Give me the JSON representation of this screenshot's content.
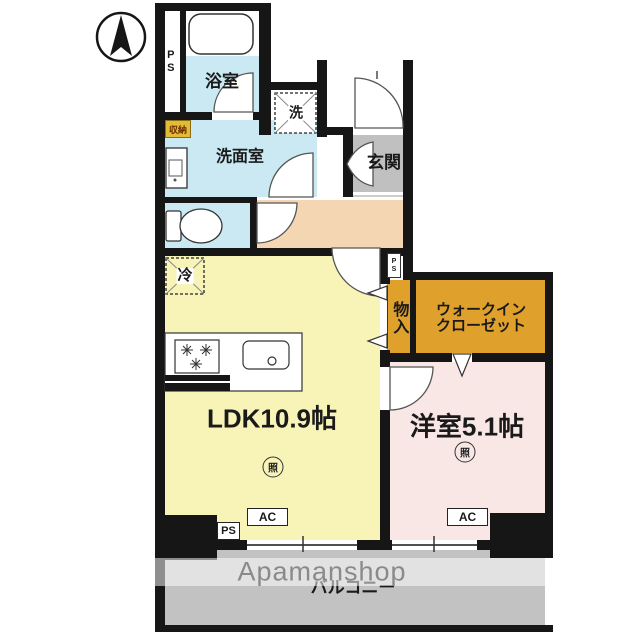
{
  "plan": {
    "type": "floorplan",
    "watermark": "Apamanshop",
    "labels": {
      "bath": "浴室",
      "washer": "洗",
      "closet_small": "収納",
      "washroom": "洗面室",
      "entrance": "玄関",
      "fridge": "冷",
      "ldk": "LDK10.9帖",
      "wic_line1": "ウォークイン",
      "wic_line2": "クローゼット",
      "storage": "物入",
      "western_room": "洋室5.1帖",
      "balcony": "バルコニー",
      "ps_top": "PS",
      "ps_mid": "PS",
      "ps_bottom": "PS",
      "ac_ldk": "AC",
      "ac_western": "AC",
      "light_ldk": "照",
      "light_western": "照"
    },
    "icons": {
      "compass": "north-arrow"
    },
    "colors": {
      "wall": "#161616",
      "bath_cyan": "#cbe9f2",
      "hall_peach": "#f4d6b3",
      "entrance_gray": "#c0c0c0",
      "ldk_yellow": "#f8f4b7",
      "western_pink": "#f9e7e6",
      "closet_orange": "#dfa02c",
      "storage_tag_yellow": "#e2bc35",
      "balcony_gray": "#c2c2c2",
      "watermark_gray": "#8a8a8a"
    }
  }
}
